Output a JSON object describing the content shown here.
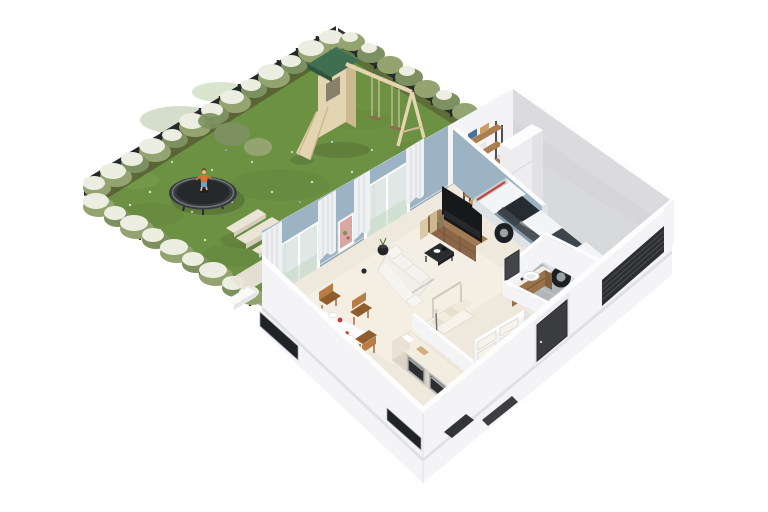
{
  "scene": {
    "type": "isometric-3d-floor-plan",
    "style": "cutaway dollhouse render, no roof, transparent background",
    "garden": {
      "elements": [
        "lawn",
        "black-fence",
        "white-flowering-hedges",
        "green-bushes",
        "trampoline",
        "jumping-child",
        "wooden-playset-with-green-roof-slide-and-swings",
        "picnic-table",
        "terrace-strip"
      ]
    },
    "house": {
      "rooms": [
        {
          "name": "living-room",
          "furniture": [
            "white-sofa",
            "black-coffee-table",
            "tv",
            "wooden-tv-console",
            "white-curtains",
            "sliding-glass-doors",
            "wall-art-frame",
            "floor-vases",
            "black-planter-pot",
            "area-rug"
          ]
        },
        {
          "name": "dining-area",
          "furniture": [
            "white-dining-table",
            "five-wooden-chairs",
            "plates",
            "pizza",
            "red-bowls"
          ]
        },
        {
          "name": "kitchen",
          "furniture": [
            "counter-run",
            "two-built-in-ovens",
            "black-floor-mat",
            "potted-plant",
            "low-backsplash-wall"
          ]
        },
        {
          "name": "staircase",
          "furniture": [
            "steps",
            "railing",
            "floor-lamp"
          ]
        },
        {
          "name": "bathroom",
          "furniture": [
            "wood-vanity",
            "round-white-sink",
            "dark-mirror",
            "toilet",
            "marble-floor"
          ]
        },
        {
          "name": "hallway",
          "furniture": [
            "built-in-shelf-closet",
            "front-door",
            "door-mats"
          ]
        },
        {
          "name": "garage",
          "furniture": [
            "white-coupe-car",
            "metal-storage-shelf",
            "colored-storage-boxes",
            "tall-white-cabinet",
            "sectional-garage-door"
          ]
        }
      ]
    }
  },
  "palette": {
    "bg": "#ffffff",
    "lawn": "#6d9143",
    "lawn2": "#597c33",
    "lawn3": "#82a855",
    "hedgeGreen": "#94a471",
    "hedgeGreen2": "#7c9060",
    "hedgeWhite": "#eceee2",
    "fence": "#26282b",
    "soil": "#473a2a",
    "wood": "#e3d4b2",
    "woodDark": "#cdb98f",
    "roof": "#3f6e51",
    "tramp": "#383c40",
    "trampIn": "#26292c",
    "trampRim": "#7e8389",
    "skin": "#e9b48c",
    "shirt": "#dd7330",
    "shorts": "#6aa3c6",
    "hair": "#6f4c2c",
    "picnic": "#eae4d6",
    "picnicSide": "#d5cebc",
    "patio": "#e9e4da",
    "wall": "#f4f4f6",
    "wallShade": "#e2e2e6",
    "wallTop": "#fdfdfe",
    "wallGray": "#d6d5d9",
    "blue": "#9cb3c3",
    "floor": "#efe8dc",
    "floor2": "#f7f2ea",
    "bathFloor": "#b3b6b8",
    "bathFloor2": "#cfd2d4",
    "glass": "#dfe8e4",
    "glassGreen": "#c3d4bf",
    "curtain": "#eef0f2",
    "curtainShade": "#cfd5da",
    "rug": "#f3eee4",
    "sofa": "#f1efe9",
    "sofaShade": "#e0ddd5",
    "cTable": "#2a2b2d",
    "console": "#8a6547",
    "console2": "#a17a56",
    "tv": "#17181a",
    "table": "#fbfbfb",
    "tableSide": "#e5e5e3",
    "chair": "#b97c42",
    "chairDark": "#8f5c2d",
    "cab": "#ddd6c8",
    "cabFront": "#e9e2d4",
    "counterTop": "#f3ede1",
    "applc": "#2c2e30",
    "steel": "#a8acaf",
    "car": "#f3f4f6",
    "carShade": "#dfe2e5",
    "carDark": "#c6cbcf",
    "carGlass": "#272c31",
    "carGlass2": "#3d444b",
    "tail": "#c23d31",
    "wheel": "#1d1f22",
    "rim": "#9ba0a4",
    "gdoor": "#2c2e31",
    "gdoorSlat": "#474a4e",
    "shelf": "#ab7e50",
    "shelfFrame": "#3b3d40",
    "boxRed": "#b2463c",
    "boxBlue": "#47729a",
    "boxNavy": "#2e4a68",
    "boxTan": "#c89c66",
    "vanity": "#9a7349",
    "vanity2": "#82603d",
    "white": "#ffffff",
    "plant": "#5d8c49",
    "plant2": "#477238",
    "pot": "#c9b9a2",
    "door": "#3b3c40",
    "mat": "#323437",
    "art": "#daa8a4",
    "mirror": "#43464a",
    "garageFloor": "#d8d9db"
  }
}
